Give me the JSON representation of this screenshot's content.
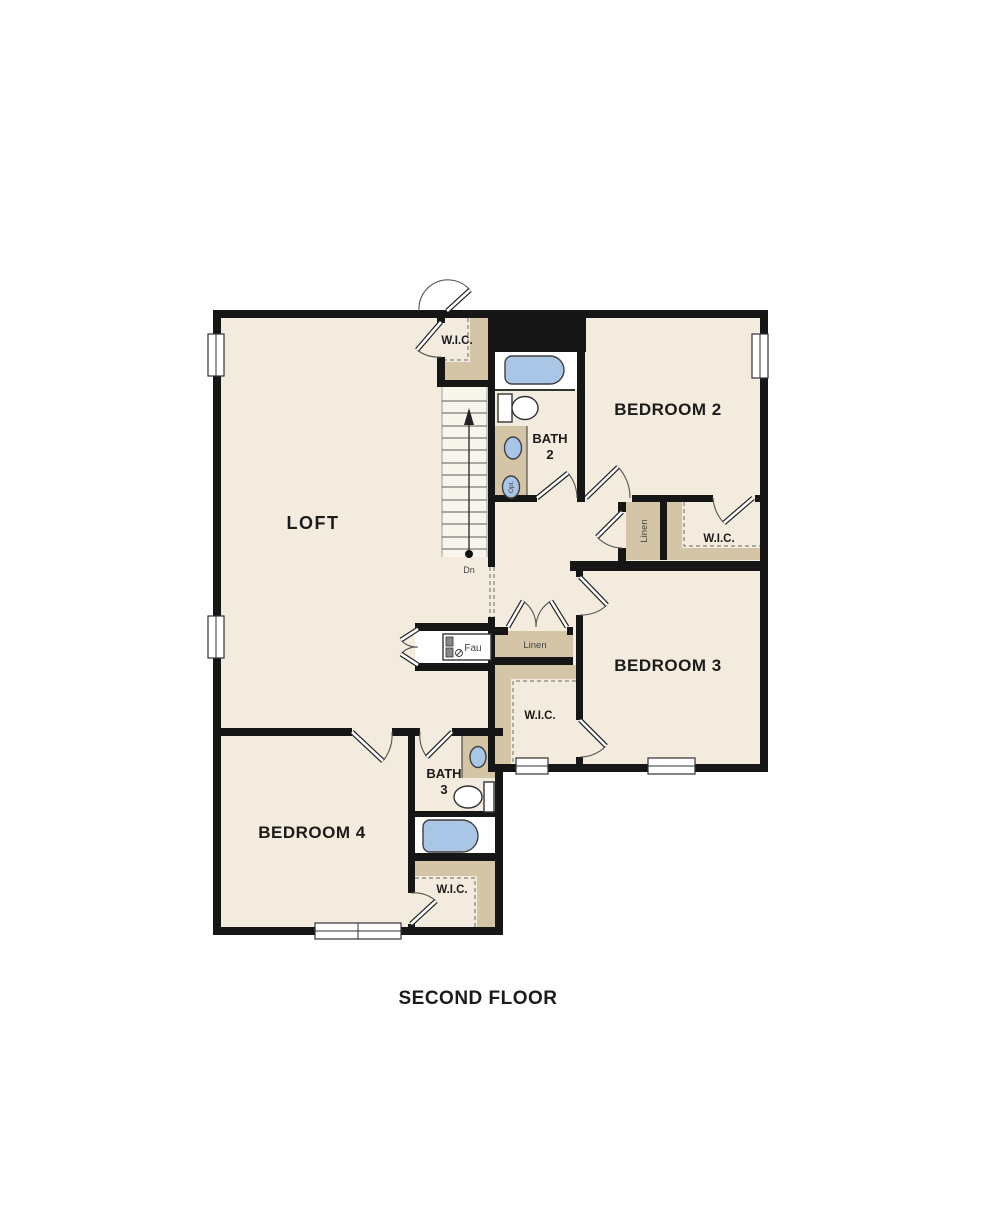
{
  "title": "SECOND FLOOR",
  "colors": {
    "wall": "#161616",
    "room_fill": "#f2ebde",
    "shelf_tan": "#d5c5a7",
    "fixture_blue": "#a9c6e6",
    "background": "#ffffff"
  },
  "rooms": {
    "loft": {
      "label": "LOFT"
    },
    "bedroom2": {
      "label": "BEDROOM 2"
    },
    "bedroom3": {
      "label": "BEDROOM 3"
    },
    "bedroom4": {
      "label": "BEDROOM 4"
    },
    "bath2": {
      "line1": "BATH",
      "line2": "2"
    },
    "bath3": {
      "line1": "BATH",
      "line2": "3"
    }
  },
  "closets": {
    "wic_top": {
      "label": "W.I.C."
    },
    "wic_bedroom2": {
      "label": "W.I.C."
    },
    "wic_bedroom3": {
      "label": "W.I.C."
    },
    "wic_bedroom4": {
      "label": "W.I.C."
    },
    "linen_upper": {
      "label": "Linen"
    },
    "linen_lower": {
      "label": "Linen"
    },
    "fau": {
      "label": "Fau"
    }
  },
  "stairs": {
    "down_label": "Dn"
  },
  "fixtures": {
    "optional_sink": "Opt."
  }
}
